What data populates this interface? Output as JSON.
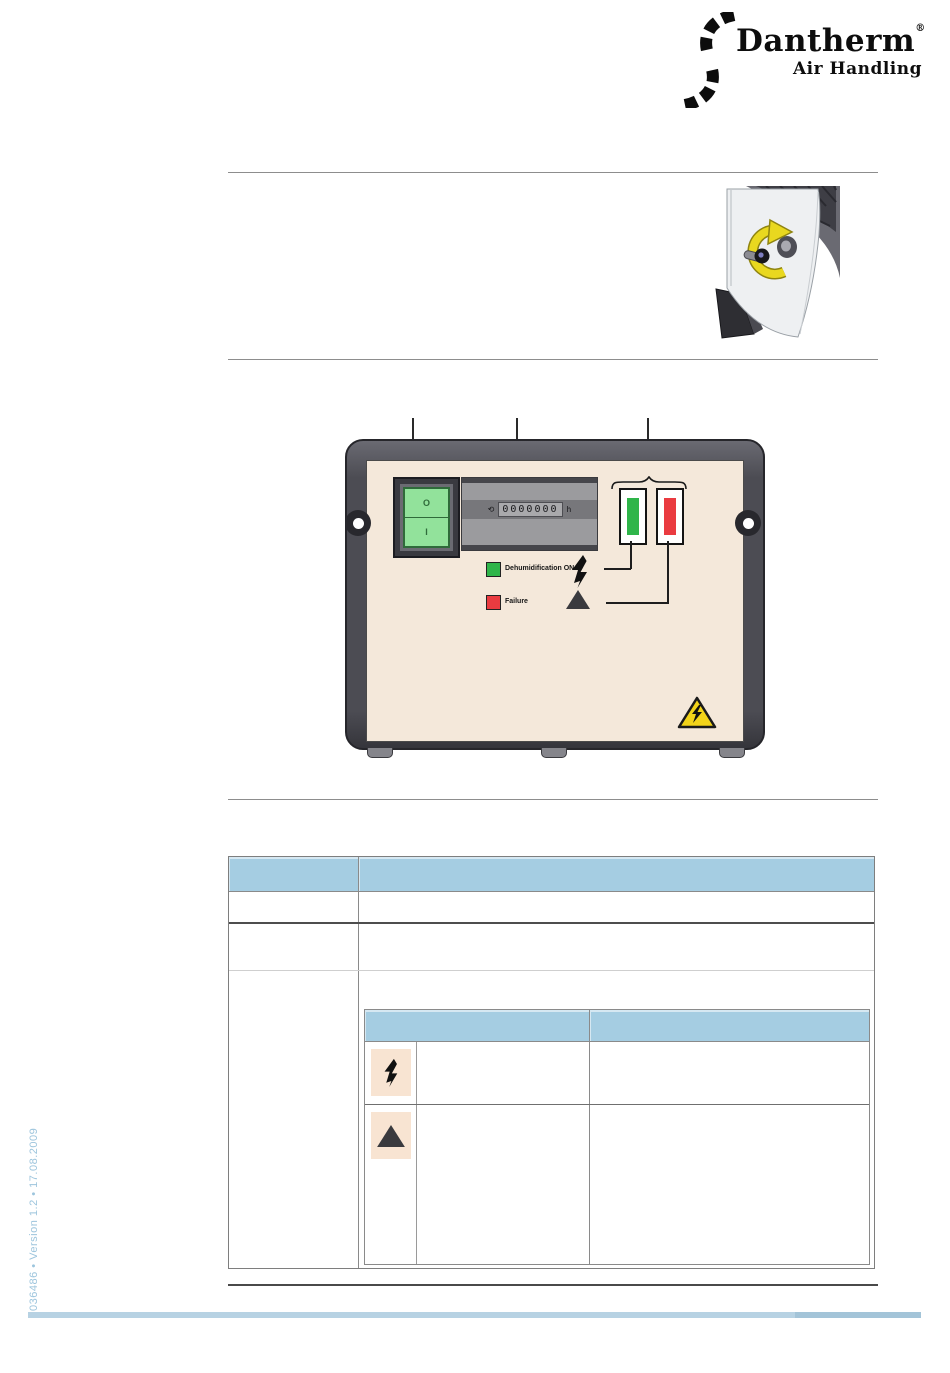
{
  "logo": {
    "brand": "Dantherm",
    "registered": "®",
    "subtitle": "Air Handling",
    "swirl_icon": "dantherm-swirl"
  },
  "figures": {
    "access_photo": {
      "subject": "dehumidifier corner with panel locking knob",
      "annotation_icon": "rotate-knob-yellow-arrow"
    },
    "control_panel": {
      "switch": {
        "off_label": "O",
        "on_label": "I"
      },
      "hour_counter": {
        "left_symbol": "⟲",
        "digits": "0000000",
        "unit_symbol": "h"
      },
      "lamps": [
        {
          "name": "dehumidification-lamp",
          "color": "#2fb54a"
        },
        {
          "name": "failure-lamp",
          "color": "#ea3b40"
        }
      ],
      "legend": [
        {
          "swatch_color": "#2fb54a",
          "label": "Dehumidification  ON",
          "icon": "high-voltage-bolt"
        },
        {
          "swatch_color": "#ea3b40",
          "label": "Failure",
          "icon": "warning-triangle"
        }
      ],
      "hazard_sticker": "high-voltage-warning-triangle"
    }
  },
  "table": {
    "header": {
      "col1": "",
      "col2": ""
    },
    "rows": [
      {
        "col1": "",
        "col2": ""
      },
      {
        "col1": "",
        "col2": ""
      },
      {
        "col1": ""
      }
    ],
    "nested": {
      "header": {
        "col1": "",
        "col2": ""
      },
      "rows": [
        {
          "icon": "high-voltage-bolt",
          "col2": "",
          "col3": ""
        },
        {
          "icon": "warning-triangle",
          "col2": "",
          "col3": ""
        }
      ]
    }
  },
  "footer": {
    "doc_ref": "036486 • Version 1.2 • 17.08.2009"
  },
  "colors": {
    "table_header_blue": "#a5cde2",
    "panel_face_beige": "#f4e8da",
    "icon_box_beige": "#f8e4d2",
    "lamp_green": "#2fb54a",
    "lamp_red": "#ea3b40",
    "hazard_yellow": "#f2d319",
    "footer_blue": "#b7d2e3",
    "doc_ref_blue": "#9dc5dd"
  }
}
